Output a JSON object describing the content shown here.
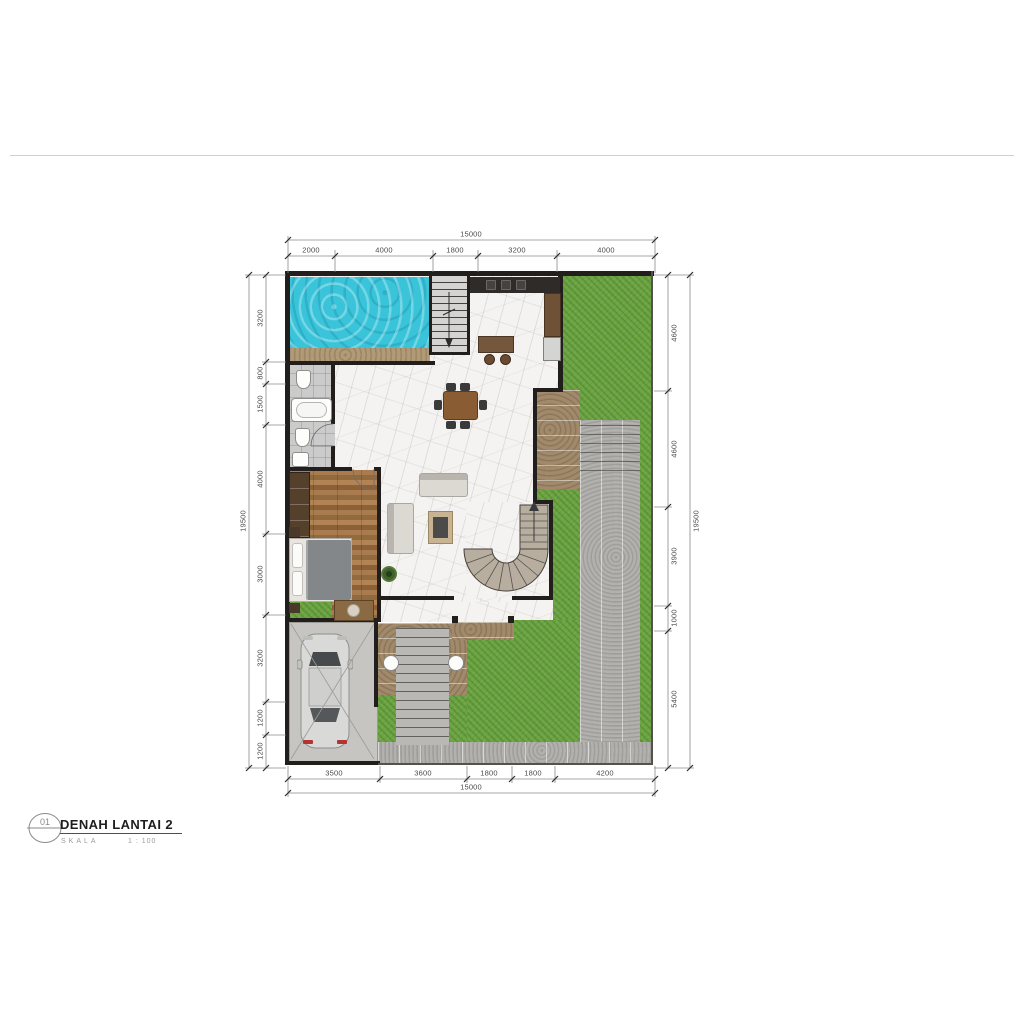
{
  "title_block": {
    "drawing_number": "01",
    "title": "DENAH LANTAI 2",
    "scale_label": "SKALA",
    "scale_value": "1 : 100"
  },
  "dimensions": {
    "top": {
      "total": "15000",
      "segments": [
        "2000",
        "4000",
        "1800",
        "3200",
        "4000"
      ]
    },
    "bottom": {
      "total": "15000",
      "segments": [
        "3500",
        "3600",
        "1800",
        "1800",
        "4200"
      ]
    },
    "left": {
      "total": "19500",
      "segments": [
        "3200",
        "800",
        "1500",
        "4000",
        "3000",
        "3200",
        "1200",
        "1200"
      ]
    },
    "right": {
      "total": "19500",
      "segments": [
        "4600",
        "4600",
        "3900",
        "1000",
        "5400"
      ]
    }
  },
  "colors": {
    "pool_water": "#3ac4da",
    "grass": "#6ba441",
    "wall": "#221e1b",
    "wood_floor": "#a87c4e",
    "marble_floor": "#f4f3f1",
    "paver": "#a18a6b",
    "path": "#b2b1ad",
    "pool_deck": "#b09a77"
  }
}
